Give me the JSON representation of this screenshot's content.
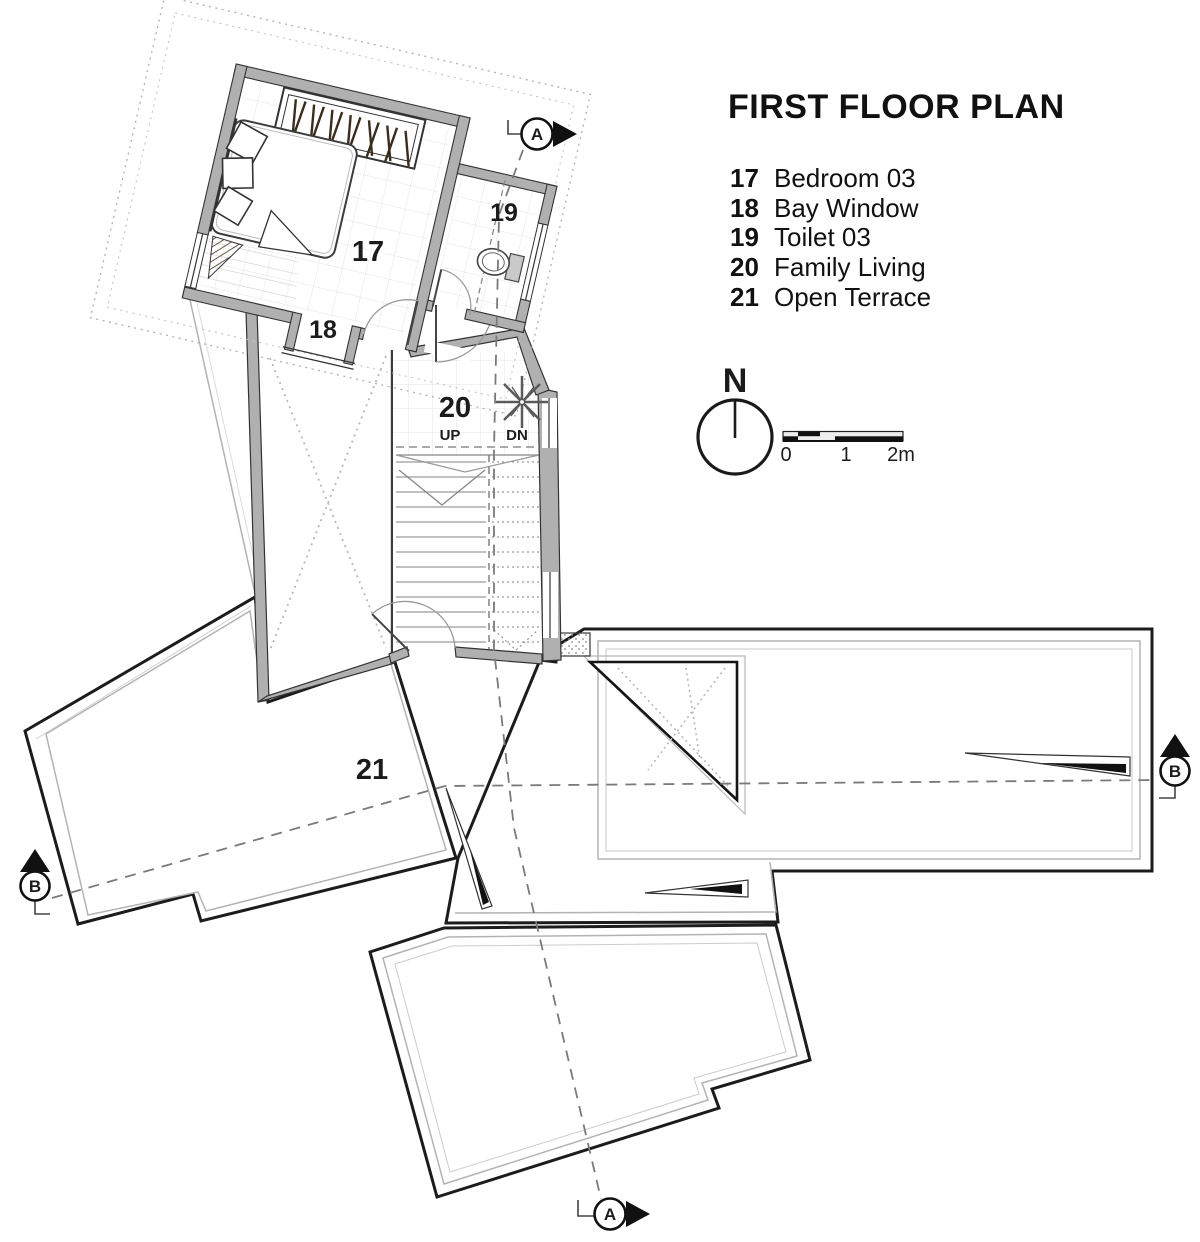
{
  "title": "FIRST FLOOR PLAN",
  "legend": {
    "items": [
      {
        "number": "17",
        "label": "Bedroom 03"
      },
      {
        "number": "18",
        "label": "Bay Window"
      },
      {
        "number": "19",
        "label": "Toilet 03"
      },
      {
        "number": "20",
        "label": "Family Living"
      },
      {
        "number": "21",
        "label": "Open Terrace"
      }
    ]
  },
  "compass": {
    "label": "N"
  },
  "scale_bar": {
    "tick0": "0",
    "tick1": "1",
    "tick2": "2m"
  },
  "plan": {
    "room_labels": {
      "bedroom": "17",
      "bay_window": "18",
      "toilet": "19",
      "family_living": "20",
      "open_terrace": "21"
    },
    "stairs": {
      "up": "UP",
      "down": "DN"
    },
    "sections": {
      "a": "A",
      "b": "B"
    }
  },
  "colors": {
    "paper": "#ffffff",
    "wall_fill": "#b0b0b0",
    "outline": "#1c1c1c",
    "dashed_line": "#7a7a7a",
    "dotted_line": "#a8a8a8",
    "text": "#141414"
  }
}
